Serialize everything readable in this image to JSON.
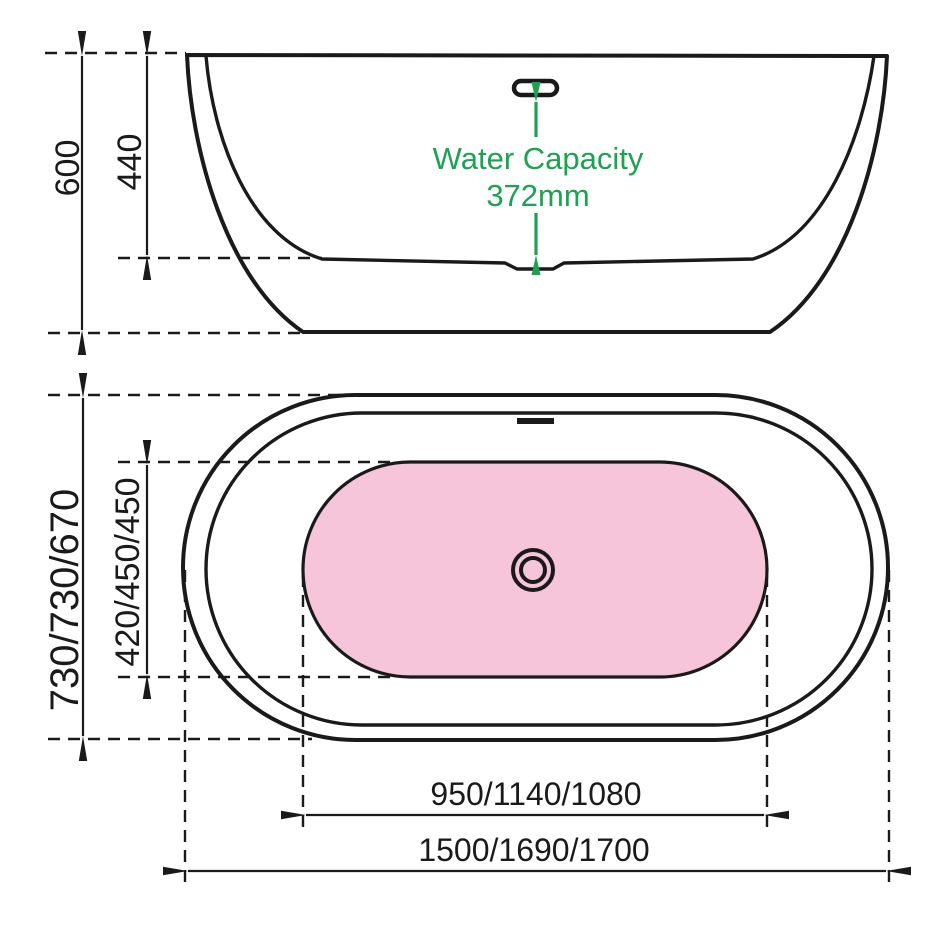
{
  "title": "Bathtub dimension diagram",
  "colors": {
    "line": "#1a1a1a",
    "green": "#1ba352",
    "pink": "#f7c5da",
    "bg": "#ffffff"
  },
  "side_view": {
    "overall_height": "600",
    "inner_depth": "440",
    "water_capacity_label": "Water Capacity",
    "water_capacity_value": "372mm"
  },
  "plan_view": {
    "overall_width": "730/730/670",
    "inner_width": "420/450/450",
    "inner_length": "950/1140/1080",
    "overall_length": "1500/1690/1700"
  }
}
